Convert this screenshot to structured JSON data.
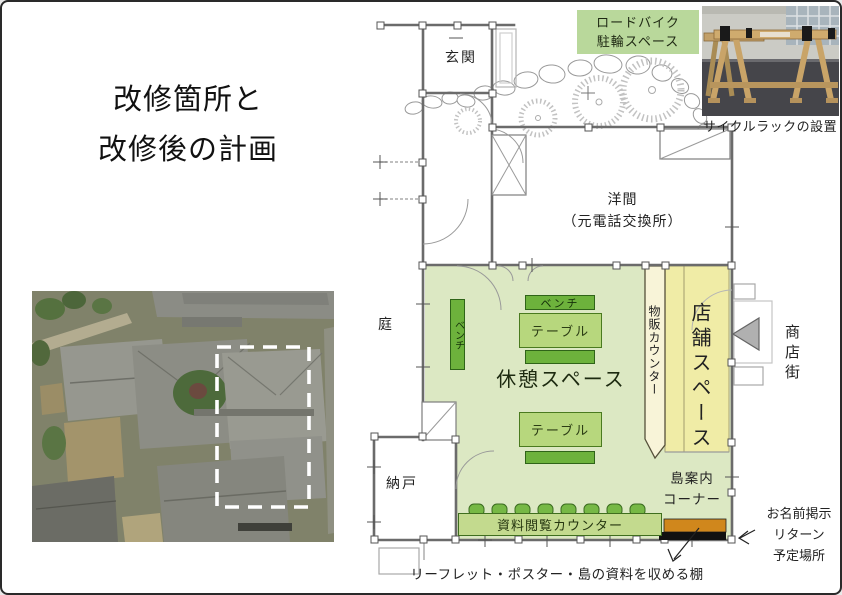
{
  "title": {
    "line1": "改修箇所と",
    "line2": "改修後の計画"
  },
  "bike_area": {
    "label_line1": "ロードバイク",
    "label_line2": "駐輪スペース",
    "photo_caption": "サイクルラックの設置"
  },
  "plan": {
    "rooms": {
      "entrance": "玄関",
      "western_room_line1": "洋間",
      "western_room_line2": "（元電話交換所）",
      "garden": "庭",
      "storage": "納戸",
      "rest_space": "休憩スペース",
      "store_space": "店舗スペース",
      "shopping_street": "商店街"
    },
    "furniture": {
      "bench_left": "ベンチ",
      "bench_top": "ベンチ",
      "table_upper": "テーブル",
      "table_lower": "テーブル",
      "goods_counter": "物販カウンター",
      "reading_counter": "資料閲覧カウンター"
    },
    "island_corner_line1": "島案内",
    "island_corner_line2": "コーナー",
    "name_return_line1": "お名前掲示",
    "name_return_line2": "リターン",
    "name_return_line3": "予定場所",
    "shelf_caption": "リーフレット・ポスター・島の資料を収める棚"
  },
  "colors": {
    "rest_area_green": "#dce8c3",
    "bench_green": "#6db23c",
    "table_green": "#b7d77d",
    "goods_counter_cream": "#f8f4d8",
    "store_yellow": "#f0eca6",
    "reading_counter_green": "#c3da8e",
    "stool_green": "#76b845",
    "shelf_orange": "#d0871c",
    "shelf_base_black": "#111111",
    "bike_label_green": "#b9d89b",
    "street_arrow_gray": "#b0b0b0",
    "highlight_dash_white": "#ffffff"
  }
}
